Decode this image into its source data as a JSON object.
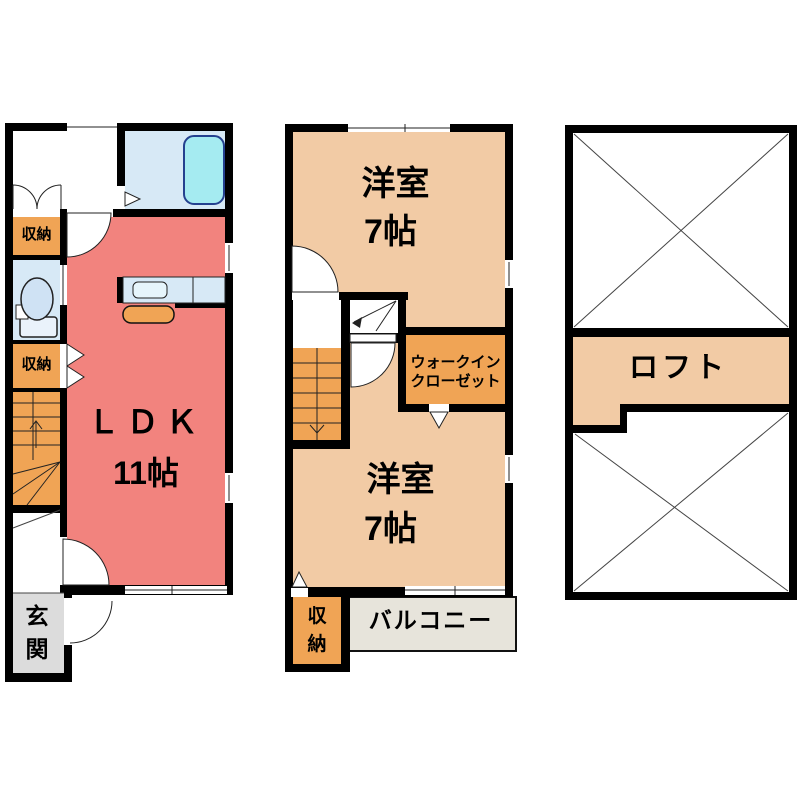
{
  "title": "apartment-floor-plan",
  "colors": {
    "wall": "#000000",
    "ldk": "#f2837e",
    "tan": "#f2cba5",
    "orange": "#f0a455",
    "aqua": "#d7e9f6",
    "tub": "#a5ebf1",
    "tubline": "#24418f",
    "gray": "#dcdcdc",
    "balcony": "#e7e4db"
  },
  "floor1": {
    "ldk_line1": "ＬＤＫ",
    "ldk_line2": "11帖",
    "closet_top": "収納",
    "closet_mid": "収納",
    "entrance": "玄関"
  },
  "floor2": {
    "room_top_line1": "洋室",
    "room_top_line2": "7帖",
    "wic_line1": "ウォークイン",
    "wic_line2": "クローゼット",
    "room_bottom_line1": "洋室",
    "room_bottom_line2": "7帖",
    "closet": "収納",
    "balcony": "バルコニー"
  },
  "floor3": {
    "loft": "ロフト"
  }
}
